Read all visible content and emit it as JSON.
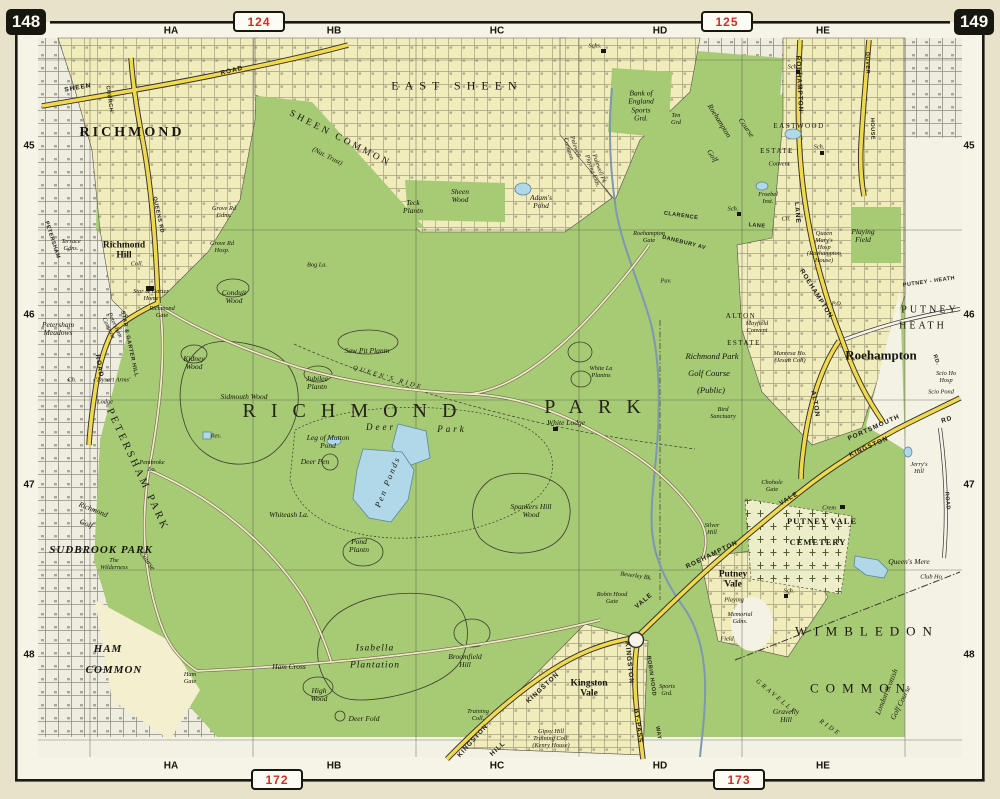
{
  "page": {
    "left_number": "148",
    "right_number": "149"
  },
  "route_boxes": [
    {
      "label": "124",
      "x": 233,
      "y": 11
    },
    {
      "label": "125",
      "x": 701,
      "y": 11
    },
    {
      "label": "172",
      "x": 251,
      "y": 769
    },
    {
      "label": "173",
      "x": 713,
      "y": 769
    }
  ],
  "grid": {
    "columns": [
      "HA",
      "HB",
      "HC",
      "HD",
      "HE"
    ],
    "column_x": [
      171,
      334,
      497,
      660,
      823
    ],
    "rows": [
      "45",
      "46",
      "47",
      "48"
    ],
    "row_y": [
      146,
      315,
      485,
      655
    ],
    "top_y": 31,
    "bottom_y": 766,
    "left_x": 29,
    "right_x": 969
  },
  "colors": {
    "park_green": "#a7ca74",
    "urban_yellow": "#f1ecbc",
    "urban_white": "#f2f0e2",
    "road_yellow": "#f0d94e",
    "water_blue": "#b0d8e9",
    "page_cream": "#e8e2cb",
    "margin_white": "#f6f4e6",
    "frame_black": "#1a1913",
    "route_red": "#cc2f25",
    "label_ink": "#16150f"
  },
  "labels": [
    {
      "t": "RICHMOND",
      "x": 132,
      "y": 133,
      "c": "c1"
    },
    {
      "t": "EAST SHEEN",
      "x": 457,
      "y": 86,
      "c": "c2"
    },
    {
      "t": "SHEEN COMMON",
      "x": 340,
      "y": 139,
      "c": "nt",
      "r": 27
    },
    {
      "t": "(Nat. Trust)",
      "x": 327,
      "y": 157,
      "c": "nti",
      "r": 27
    },
    {
      "t": "Sheen\nWood",
      "x": 460,
      "y": 196,
      "c": "s"
    },
    {
      "t": "Teck\nPlantn",
      "x": 413,
      "y": 207,
      "c": "s"
    },
    {
      "t": "Adam's\nPond",
      "x": 541,
      "y": 202,
      "c": "s"
    },
    {
      "t": "Roehampton\nGate",
      "x": 649,
      "y": 238,
      "c": "t"
    },
    {
      "t": "Bog La.",
      "x": 317,
      "y": 266,
      "c": "t"
    },
    {
      "t": "Conduit\nWood",
      "x": 234,
      "y": 297,
      "c": "s"
    },
    {
      "t": "Kidney\nWood",
      "x": 194,
      "y": 363,
      "c": "s"
    },
    {
      "t": "Saw Pit Plantn",
      "x": 367,
      "y": 351,
      "c": "s"
    },
    {
      "t": "Jubilee\nPlantn",
      "x": 317,
      "y": 383,
      "c": "s"
    },
    {
      "t": "QUEEN'S RIDE",
      "x": 388,
      "y": 378,
      "c": "ri",
      "r": 16
    },
    {
      "t": "Sidmouth Wood",
      "x": 244,
      "y": 397,
      "c": "s"
    },
    {
      "t": "RICHMOND",
      "x": 357,
      "y": 411,
      "c": "bp"
    },
    {
      "t": "PARK",
      "x": 600,
      "y": 407,
      "c": "bp"
    },
    {
      "t": "Deer",
      "x": 381,
      "y": 427,
      "c": "dp"
    },
    {
      "t": "Park",
      "x": 452,
      "y": 429,
      "c": "dp"
    },
    {
      "t": "Leg of Mutton\nPond",
      "x": 328,
      "y": 442,
      "c": "s"
    },
    {
      "t": "Deer Pen",
      "x": 315,
      "y": 462,
      "c": "s"
    },
    {
      "t": "Pen Ponds",
      "x": 388,
      "y": 482,
      "c": "pp",
      "r": -68
    },
    {
      "t": "Res.",
      "x": 216,
      "y": 437,
      "c": "t"
    },
    {
      "t": "Whiteash La.",
      "x": 289,
      "y": 515,
      "c": "s"
    },
    {
      "t": "Pond\nPlantn",
      "x": 359,
      "y": 546,
      "c": "s"
    },
    {
      "t": "Spankers Hill\nWood",
      "x": 531,
      "y": 511,
      "c": "s"
    },
    {
      "t": "White Lodge",
      "x": 566,
      "y": 423,
      "c": "s"
    },
    {
      "t": "White La\nPlantns",
      "x": 601,
      "y": 373,
      "c": "t"
    },
    {
      "t": "Richmond Park",
      "x": 712,
      "y": 357,
      "c": "g"
    },
    {
      "t": "Golf Course",
      "x": 709,
      "y": 374,
      "c": "g"
    },
    {
      "t": "(Public)",
      "x": 711,
      "y": 391,
      "c": "g"
    },
    {
      "t": "Bird\nSanctuary",
      "x": 723,
      "y": 414,
      "c": "t"
    },
    {
      "t": "Silver\nHill",
      "x": 712,
      "y": 530,
      "c": "t"
    },
    {
      "t": "Chohole\nGate",
      "x": 772,
      "y": 487,
      "c": "t"
    },
    {
      "t": "Jerry's\nHill",
      "x": 919,
      "y": 469,
      "c": "t"
    },
    {
      "t": "PUTNEY VALE",
      "x": 822,
      "y": 522,
      "c": "cem"
    },
    {
      "t": "CEMETERY",
      "x": 818,
      "y": 543,
      "c": "cem"
    },
    {
      "t": "Crem",
      "x": 829,
      "y": 509,
      "c": "t"
    },
    {
      "t": "Putney\nVale",
      "x": 733,
      "y": 580,
      "c": "t3"
    },
    {
      "t": "Queen's Mere",
      "x": 909,
      "y": 562,
      "c": "s"
    },
    {
      "t": "Club Ho",
      "x": 931,
      "y": 578,
      "c": "t"
    },
    {
      "t": "PUTNEY",
      "x": 930,
      "y": 310,
      "c": "ph"
    },
    {
      "t": "HEATH",
      "x": 923,
      "y": 326,
      "c": "ph"
    },
    {
      "t": "Roehampton",
      "x": 881,
      "y": 356,
      "c": "town"
    },
    {
      "t": "ALTON",
      "x": 741,
      "y": 317,
      "c": "est"
    },
    {
      "t": "ESTATE",
      "x": 744,
      "y": 344,
      "c": "est"
    },
    {
      "t": "Mayfield\nConvent",
      "x": 757,
      "y": 328,
      "c": "t"
    },
    {
      "t": "Manresa Ho.\n(Jesuit Coll)",
      "x": 790,
      "y": 358,
      "c": "t"
    },
    {
      "t": "EASTWOOD",
      "x": 799,
      "y": 127,
      "c": "est"
    },
    {
      "t": "ESTATE",
      "x": 777,
      "y": 152,
      "c": "est"
    },
    {
      "t": "Convent",
      "x": 779,
      "y": 165,
      "c": "t"
    },
    {
      "t": "Froebel\nInst.",
      "x": 768,
      "y": 199,
      "c": "t"
    },
    {
      "t": "Queen\nMary's\nHosp\n(Roehampton\nHouse)",
      "x": 824,
      "y": 248,
      "c": "t"
    },
    {
      "t": "Playing\nField",
      "x": 863,
      "y": 236,
      "c": "s"
    },
    {
      "t": "Ten\nGrd",
      "x": 676,
      "y": 120,
      "c": "t"
    },
    {
      "t": "Bank of\nEngland\nSports\nGrd.",
      "x": 641,
      "y": 106,
      "c": "s"
    },
    {
      "t": "Roehampton",
      "x": 719,
      "y": 121,
      "c": "gs",
      "r": 58
    },
    {
      "t": "Golf",
      "x": 712,
      "y": 156,
      "c": "gs",
      "r": 55
    },
    {
      "t": "Course",
      "x": 746,
      "y": 128,
      "c": "gs",
      "r": 55
    },
    {
      "t": "Palewell\nCommon",
      "x": 571,
      "y": 148,
      "c": "t",
      "r": 72
    },
    {
      "t": "Palewell Pk\nPlaying Flds.",
      "x": 595,
      "y": 170,
      "c": "t",
      "r": 70
    },
    {
      "t": "PETERSHAM PARK",
      "x": 137,
      "y": 470,
      "c": "ppk",
      "r": 65
    },
    {
      "t": "Richmond",
      "x": 93,
      "y": 510,
      "c": "gs",
      "r": 22
    },
    {
      "t": "Golf",
      "x": 86,
      "y": 524,
      "c": "gs",
      "r": 22
    },
    {
      "t": "Course",
      "x": 147,
      "y": 561,
      "c": "gs",
      "r": 55
    },
    {
      "t": "SUDBROOK PARK",
      "x": 101,
      "y": 550,
      "c": "ar"
    },
    {
      "t": "The\nWilderness",
      "x": 114,
      "y": 565,
      "c": "t"
    },
    {
      "t": "Pembroke\nLo.",
      "x": 152,
      "y": 467,
      "c": "t"
    },
    {
      "t": "HAM",
      "x": 108,
      "y": 649,
      "c": "ar"
    },
    {
      "t": "COMMON",
      "x": 114,
      "y": 670,
      "c": "ar"
    },
    {
      "t": "Ham\nGate",
      "x": 190,
      "y": 679,
      "c": "t"
    },
    {
      "t": "Ham Cross",
      "x": 289,
      "y": 667,
      "c": "s"
    },
    {
      "t": "Isabella\nPlantation",
      "x": 375,
      "y": 657,
      "c": "iso"
    },
    {
      "t": "High\nWood",
      "x": 319,
      "y": 695,
      "c": "s"
    },
    {
      "t": "Deer Fold",
      "x": 364,
      "y": 719,
      "c": "s"
    },
    {
      "t": "Broomfield\nHill",
      "x": 465,
      "y": 661,
      "c": "s"
    },
    {
      "t": "Training\nColl.",
      "x": 478,
      "y": 716,
      "c": "t"
    },
    {
      "t": "Sports\nGrd.",
      "x": 667,
      "y": 691,
      "c": "t"
    },
    {
      "t": "Kingston\nVale",
      "x": 589,
      "y": 689,
      "c": "t3"
    },
    {
      "t": "Gipsy Hill\nTraining Coll.\n(Kenry House)",
      "x": 551,
      "y": 739,
      "c": "t"
    },
    {
      "t": "WIMBLEDON",
      "x": 867,
      "y": 632,
      "c": "wb"
    },
    {
      "t": "COMMON",
      "x": 861,
      "y": 689,
      "c": "wb"
    },
    {
      "t": "London Scottish",
      "x": 887,
      "y": 692,
      "c": "gs",
      "r": -68
    },
    {
      "t": "Golf Course",
      "x": 901,
      "y": 703,
      "c": "gs",
      "r": -64
    },
    {
      "t": "Gravelly\nHill",
      "x": 786,
      "y": 716,
      "c": "s"
    },
    {
      "t": "GRAVELLY",
      "x": 776,
      "y": 697,
      "c": "ri",
      "r": 40
    },
    {
      "t": "RIDE",
      "x": 830,
      "y": 728,
      "c": "ri",
      "r": 35
    },
    {
      "t": "Playing",
      "x": 734,
      "y": 601,
      "c": "t"
    },
    {
      "t": "Memorial\nGdns.",
      "x": 740,
      "y": 619,
      "c": "t"
    },
    {
      "t": "Field",
      "x": 727,
      "y": 640,
      "c": "t"
    },
    {
      "t": "Petersham\nMeadows",
      "x": 58,
      "y": 329,
      "c": "s"
    },
    {
      "t": "Terrace\nGdns.",
      "x": 71,
      "y": 246,
      "c": "t"
    },
    {
      "t": "Richmond\nHill",
      "x": 124,
      "y": 251,
      "c": "t3"
    },
    {
      "t": "Coll.",
      "x": 137,
      "y": 265,
      "c": "t"
    },
    {
      "t": "Grove Rd\nGdns.",
      "x": 224,
      "y": 213,
      "c": "t"
    },
    {
      "t": "Grove Rd\nHosp.",
      "x": 222,
      "y": 248,
      "c": "t"
    },
    {
      "t": "Star & Garter\nHome",
      "x": 151,
      "y": 296,
      "c": "t"
    },
    {
      "t": "Richmond\nGate",
      "x": 162,
      "y": 313,
      "c": "t"
    },
    {
      "t": "Petersham\nCommon",
      "x": 111,
      "y": 327,
      "c": "t",
      "r": 65
    },
    {
      "t": "'Dysart Arms'",
      "x": 113,
      "y": 381,
      "c": "t"
    },
    {
      "t": "Ch.",
      "x": 72,
      "y": 381,
      "c": "t"
    },
    {
      "t": "Lodge",
      "x": 105,
      "y": 403,
      "c": "t"
    },
    {
      "t": "Scio Ho\nHosp",
      "x": 946,
      "y": 378,
      "c": "t"
    },
    {
      "t": "Scio Pond",
      "x": 941,
      "y": 393,
      "c": "t"
    },
    {
      "t": "Schs.",
      "x": 595,
      "y": 47,
      "c": "t"
    },
    {
      "t": "Sch.",
      "x": 793,
      "y": 68,
      "c": "t"
    },
    {
      "t": "Sch.",
      "x": 819,
      "y": 148,
      "c": "t"
    },
    {
      "t": "Sch.",
      "x": 733,
      "y": 210,
      "c": "t"
    },
    {
      "t": "Sch.",
      "x": 789,
      "y": 592,
      "c": "t"
    },
    {
      "t": "P.O.",
      "x": 837,
      "y": 305,
      "c": "t"
    },
    {
      "t": "Ch.",
      "x": 786,
      "y": 220,
      "c": "t"
    },
    {
      "t": "Pav.",
      "x": 666,
      "y": 282,
      "c": "t"
    },
    {
      "t": "Robin Hood\nGate",
      "x": 612,
      "y": 599,
      "c": "t"
    },
    {
      "t": "Beverley Bk.",
      "x": 636,
      "y": 577,
      "c": "t",
      "r": 8
    },
    {
      "t": "SHEEN",
      "x": 78,
      "y": 88,
      "c": "rd",
      "r": -10
    },
    {
      "t": "ROAD",
      "x": 232,
      "y": 71,
      "c": "rd",
      "r": -14
    },
    {
      "t": "CHURCH",
      "x": 109,
      "y": 99,
      "c": "rw",
      "r": 82
    },
    {
      "t": "QUEENS RD",
      "x": 158,
      "y": 215,
      "c": "rw",
      "r": 78
    },
    {
      "t": "PETERSHAM",
      "x": 52,
      "y": 240,
      "c": "rw",
      "r": 72
    },
    {
      "t": "ROAD",
      "x": 99,
      "y": 366,
      "c": "rd",
      "r": 80
    },
    {
      "t": "STAR & GARTER HILL",
      "x": 129,
      "y": 344,
      "c": "rw",
      "r": 78
    },
    {
      "t": "ROEHAMPTON",
      "x": 799,
      "y": 84,
      "c": "rd",
      "r": 87
    },
    {
      "t": "LANE",
      "x": 797,
      "y": 213,
      "c": "rd",
      "r": 85
    },
    {
      "t": "ROEHAMPTON",
      "x": 816,
      "y": 294,
      "c": "rd",
      "r": 58
    },
    {
      "t": "DOVER",
      "x": 867,
      "y": 63,
      "c": "rw",
      "r": 88
    },
    {
      "t": "HOUSE",
      "x": 872,
      "y": 129,
      "c": "rw",
      "r": 88
    },
    {
      "t": "CLARENCE",
      "x": 681,
      "y": 216,
      "c": "rw",
      "r": 8
    },
    {
      "t": "LANE",
      "x": 757,
      "y": 226,
      "c": "rw",
      "r": 5
    },
    {
      "t": "DANEBURY AV",
      "x": 684,
      "y": 243,
      "c": "rw",
      "r": 14
    },
    {
      "t": "ALTON",
      "x": 815,
      "y": 404,
      "c": "rd",
      "r": 80
    },
    {
      "t": "VALE",
      "x": 644,
      "y": 601,
      "c": "rd",
      "r": -40
    },
    {
      "t": "ROEHAMPTON",
      "x": 712,
      "y": 555,
      "c": "rd",
      "r": -26
    },
    {
      "t": "VALE",
      "x": 789,
      "y": 499,
      "c": "rd",
      "r": -31
    },
    {
      "t": "PORTSMOUTH",
      "x": 874,
      "y": 428,
      "c": "rd",
      "r": -24
    },
    {
      "t": "KINGSTON",
      "x": 869,
      "y": 447,
      "c": "rd",
      "r": -24
    },
    {
      "t": "RD",
      "x": 947,
      "y": 420,
      "c": "rd",
      "r": -18
    },
    {
      "t": "KINGSTON",
      "x": 543,
      "y": 688,
      "c": "rd",
      "r": -43
    },
    {
      "t": "KINGSTON",
      "x": 473,
      "y": 741,
      "c": "rd",
      "r": -48
    },
    {
      "t": "HILL",
      "x": 498,
      "y": 749,
      "c": "rd",
      "r": -43
    },
    {
      "t": "KINGSTON",
      "x": 629,
      "y": 663,
      "c": "rd",
      "r": 84
    },
    {
      "t": "BY-PASS",
      "x": 638,
      "y": 726,
      "c": "rd",
      "r": 83
    },
    {
      "t": "ROBIN HOOD",
      "x": 651,
      "y": 676,
      "c": "rw",
      "r": 82
    },
    {
      "t": "WAY",
      "x": 658,
      "y": 733,
      "c": "rw",
      "r": 80
    },
    {
      "t": "PUTNEY - HEATH",
      "x": 929,
      "y": 282,
      "c": "rw",
      "r": -8
    },
    {
      "t": "RD.",
      "x": 936,
      "y": 360,
      "c": "rw",
      "r": 70
    },
    {
      "t": "ROAD",
      "x": 947,
      "y": 501,
      "c": "rw",
      "r": 85
    }
  ]
}
